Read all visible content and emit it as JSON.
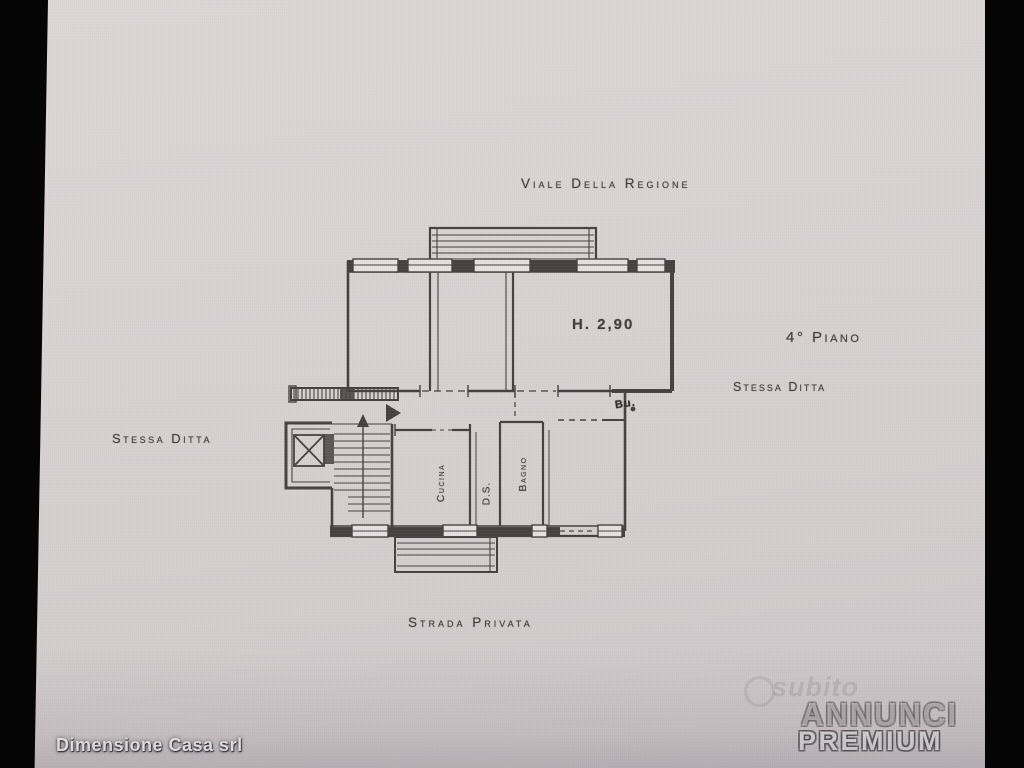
{
  "page": {
    "paper_color": "#d9d3d4",
    "bar_color": "#050505",
    "ink_color": "#45403d"
  },
  "plan": {
    "street_top": "Viale Della Regione",
    "street_bottom": "Strada Privata",
    "floor_label": "4° Piano",
    "company_note_right": "Stessa Ditta",
    "company_note_left": "Stessa Ditta",
    "ceiling_height": "H. 2,90",
    "rooms": [
      {
        "name": "Cucina"
      },
      {
        "name": "D.S."
      },
      {
        "name": "Bagno"
      }
    ],
    "door_mark": "Bu."
  },
  "footer": {
    "agency": "Dimensione Casa srl"
  },
  "watermark": {
    "faint_brand": "subito",
    "brand_line1": "ANNUNCI",
    "brand_line2": "PREMIUM"
  }
}
